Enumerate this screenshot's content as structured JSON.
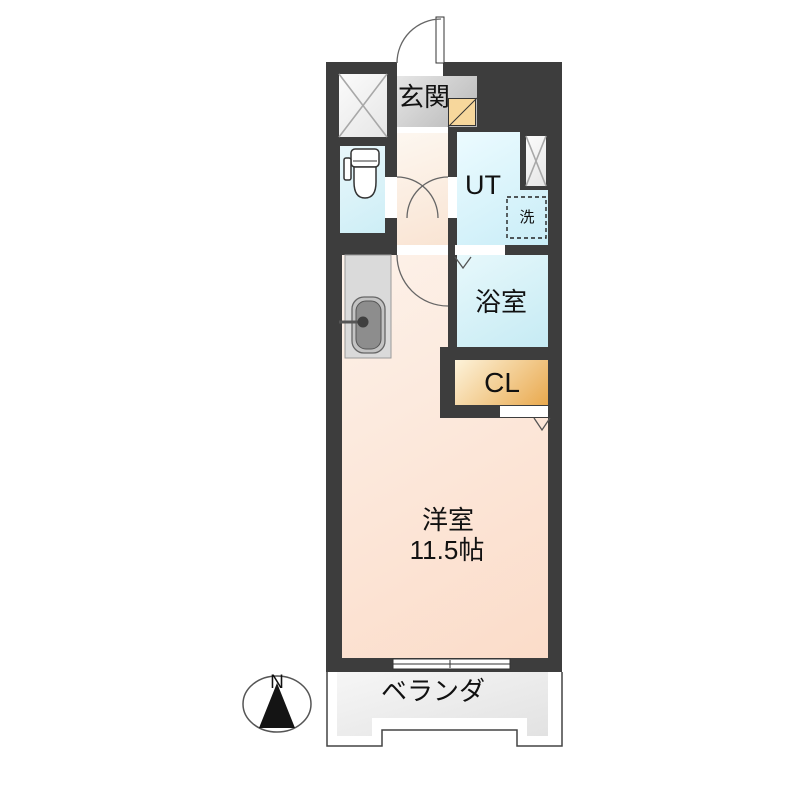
{
  "floorplan": {
    "labels": {
      "genkan": "玄関",
      "ut": "UT",
      "laundry": "洗",
      "bath": "浴室",
      "closet": "CL",
      "room_name": "洋室",
      "room_size": "11.5帖",
      "veranda": "ベランダ",
      "compass_north": "N"
    },
    "colors": {
      "wall": "#3d3d3d",
      "main_room_floor": "#fbdcc9",
      "wet_area_floor": "#cdeef6",
      "closet_floor": "#e9a94e",
      "genkan_floor": "#c0c0c0",
      "shoe_box": "#f7d79c",
      "veranda_floor": "#ececec",
      "door_line": "#555555"
    }
  }
}
